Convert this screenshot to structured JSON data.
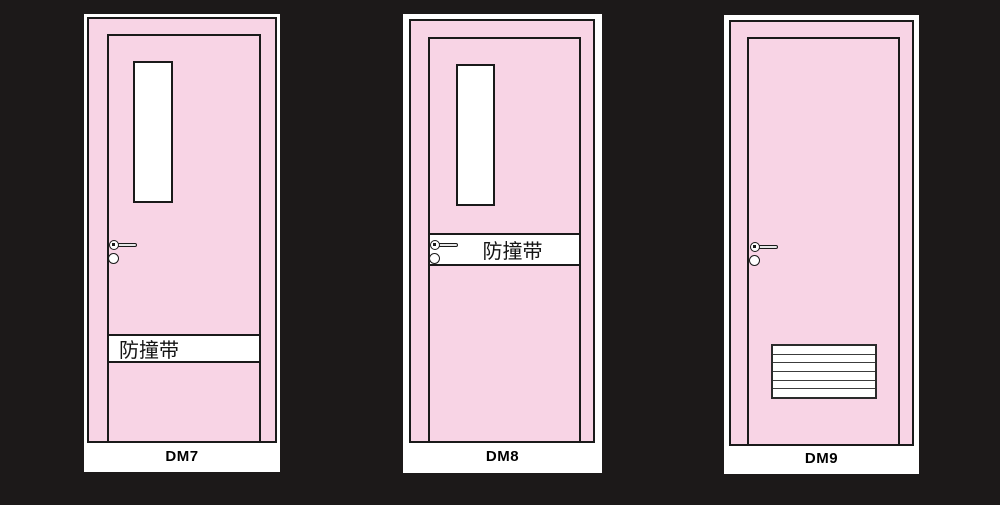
{
  "page": {
    "background_color": "#1c1919"
  },
  "colors": {
    "door_pink": "#f8d4e5",
    "outline_black": "#1a1a1a",
    "card_white": "#ffffff"
  },
  "doors": [
    {
      "code": "DM7",
      "band_label": "防撞带",
      "has_window": true,
      "has_band": true,
      "has_louver": false,
      "band_position": "lower"
    },
    {
      "code": "DM8",
      "band_label": "防撞带",
      "has_window": true,
      "has_band": true,
      "has_louver": false,
      "band_position": "middle"
    },
    {
      "code": "DM9",
      "band_label": "",
      "has_window": false,
      "has_band": false,
      "has_louver": true,
      "louver_slats": 6
    }
  ]
}
